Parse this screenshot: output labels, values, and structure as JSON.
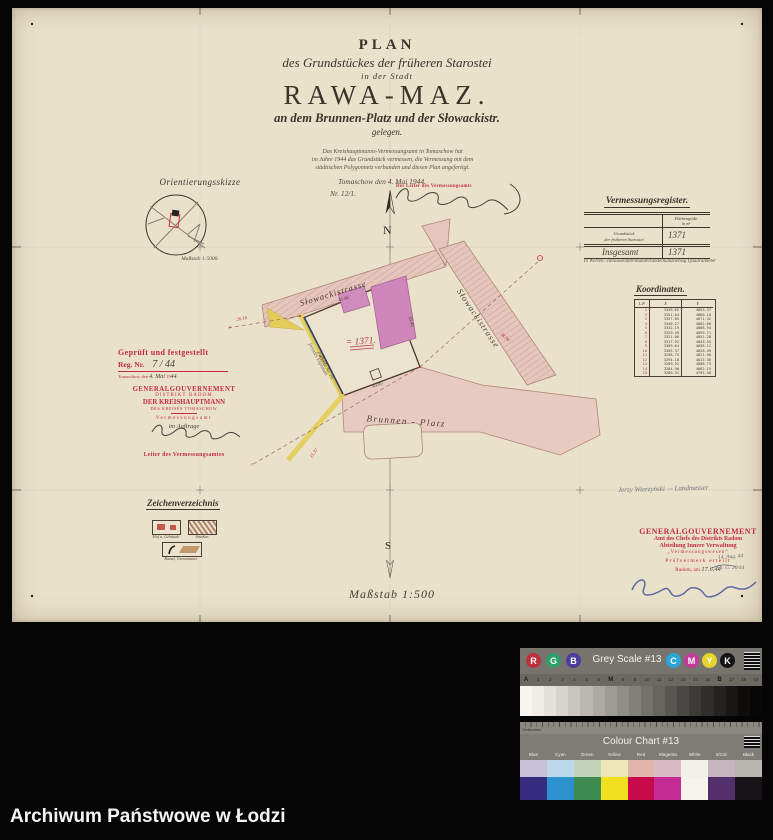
{
  "archive_bar": {
    "label": "Archiwum Państwowe w Łodzi"
  },
  "title_block": {
    "line1": "PLAN",
    "line2": "des Grundstückes der früheren Starostei",
    "line3": "in der Stadt",
    "line4": "RAWA-MAZ.",
    "line5": "an dem Brunnen-Platz und der Słowackistr.",
    "line6": "gelegen."
  },
  "certification": {
    "line1": "Das Kreishauptmanns-Vermessungsamt in Tomaschow hat",
    "line2": "im Jahre 1944 das Grundstück vermessen, die Vermessung mit dem",
    "line3": "städtischen Polygonnetz verbunden und diesen Plan angefertigt.",
    "place_date": "Tomaschow den 4. Mai 1944.",
    "number": "Nr. 12/1.",
    "stamp_label": "Der Leiter des Vermessungsamts"
  },
  "orientation": {
    "title": "Orientierungsskizze",
    "scale": "Maßstab 1:5000."
  },
  "register": {
    "title": "Vermessungsregister.",
    "col_header_1": "Flächengröße",
    "col_header_2": "in m²",
    "row1_label_1": "Grundstück",
    "row1_label_2": "der früheren Starostei",
    "row1_value": "1371",
    "row2_label": "Insgesamt",
    "row2_value": "1371",
    "in_words": "In Worten: eintausenddreihundertundeinundsiebzig Quadratmeter"
  },
  "koordinaten": {
    "title": "Koordinaten.",
    "headers": {
      "lp": "L.P.",
      "x": "X",
      "y": "Y"
    },
    "rows": [
      [
        "1",
        "3349.62",
        "4853.37"
      ],
      [
        "2",
        "3351.04",
        "4860.18"
      ],
      [
        "3",
        "3357.85",
        "4871.42"
      ],
      [
        "4",
        "3340.27",
        "4882.66"
      ],
      [
        "5",
        "3332.19",
        "4868.94"
      ],
      [
        "6",
        "3329.45",
        "4859.71"
      ],
      [
        "7",
        "3321.06",
        "4851.28"
      ],
      [
        "8",
        "3317.92",
        "4843.55"
      ],
      [
        "9",
        "3309.64",
        "4836.12"
      ],
      [
        "10",
        "3305.37",
        "4828.49"
      ],
      [
        "11",
        "3298.75",
        "4821.90"
      ],
      [
        "12",
        "3294.18",
        "4815.36"
      ],
      [
        "13",
        "3289.52",
        "4808.73"
      ],
      [
        "14",
        "3284.90",
        "4802.15"
      ],
      [
        "15",
        "3280.31",
        "4795.58"
      ]
    ]
  },
  "stamp_left": {
    "line1": "Geprüft und festgestellt",
    "reg_label": "Reg. Nr.",
    "reg_value": "7 / 44",
    "date_label": "Tomaschow, den",
    "date_value": "4. Mai",
    "year_prefix": "19",
    "year_value": "44",
    "org1": "GENERALGOUVERNEMENT",
    "org2": "DISTRIKT RADOM",
    "org3": "DER KREISHAUPTMANN",
    "org4": "DES KREISES TOMASCHOW",
    "office": "Vermessungsamt",
    "by_order": "im Auftrage",
    "signer": "Leiter des Vermessungsamtes"
  },
  "pencil_note": {
    "text": "Jerzy Wierzyński — Landmesser"
  },
  "stamp_right": {
    "line1": "GENERALGOUVERNEMENT",
    "line2": "Amt des Chefs des Distrikts Radom",
    "line3": "Abteilung Innere Verwaltung",
    "line4": "„Vermessungswesen“",
    "line5": "Prüfvermerk erteilt",
    "line6": "Radom, am",
    "line6_value": "17.6.44",
    "note1": "14. Aug. 44",
    "note2": "Nb. G. 20/44"
  },
  "plan": {
    "north": "N",
    "south": "S",
    "street_top": "Słowackistrasse",
    "street_right": "Słowackistrasse",
    "square": "Brunnen - Platz",
    "area_label": "= 1371.",
    "left_note1": "fremdes Eigentum",
    "left_note2": "Parzelle Nr. 19",
    "scale": "Maßstab 1:500",
    "measurements": [
      {
        "t": "26.10",
        "x": 230,
        "y": 312,
        "r": -9,
        "c": "red"
      },
      {
        "t": "15.37",
        "x": 303,
        "y": 446,
        "r": -55,
        "c": "red"
      },
      {
        "t": "38.94",
        "x": 492,
        "y": 330,
        "r": 42,
        "c": "red"
      },
      {
        "t": "41.66",
        "x": 332,
        "y": 292,
        "r": -17,
        "c": "ink"
      },
      {
        "t": "35.40",
        "x": 398,
        "y": 314,
        "r": 72,
        "c": "ink"
      },
      {
        "t": "43.85",
        "x": 366,
        "y": 378,
        "r": -20,
        "c": "ink"
      },
      {
        "t": "29.12",
        "x": 310,
        "y": 352,
        "r": 62,
        "c": "ink"
      },
      {
        "t": "×",
        "x": 218,
        "y": 321,
        "r": 0,
        "c": "red"
      },
      {
        "t": "×",
        "x": 240,
        "y": 458,
        "r": 0,
        "c": "red"
      }
    ]
  },
  "legend": {
    "title": "Zeichenverzeichnis",
    "items": [
      {
        "label": "Hof u. Gebäude"
      },
      {
        "label": "Straßen"
      },
      {
        "label": "Kanal, Grenzmauer"
      }
    ]
  },
  "grey_scale": {
    "title": "Grey Scale #13",
    "circles": [
      {
        "letter": "R",
        "color": "#bf2f3c",
        "x": 6
      },
      {
        "letter": "G",
        "color": "#2f9e68",
        "x": 26
      },
      {
        "letter": "B",
        "color": "#4a3e9d",
        "x": 46
      },
      {
        "letter": "C",
        "color": "#2aa6d9",
        "x": 146
      },
      {
        "letter": "M",
        "color": "#c43a9b",
        "x": 164
      },
      {
        "letter": "Y",
        "color": "#e6d32b",
        "x": 182
      },
      {
        "letter": "K",
        "color": "#151515",
        "x": 200
      }
    ],
    "ticks": [
      "A",
      "1",
      "2",
      "3",
      "4",
      "5",
      "6",
      "M",
      "8",
      "9",
      "10",
      "11",
      "12",
      "13",
      "14",
      "15",
      "B",
      "17",
      "18",
      "19"
    ],
    "steps": [
      "#f7f5ee",
      "#efede6",
      "#e3e1da",
      "#d6d4cd",
      "#c8c6bf",
      "#bab8b1",
      "#acaaa3",
      "#9e9c95",
      "#908e88",
      "#82807a",
      "#74726c",
      "#66645f",
      "#585651",
      "#4a4844",
      "#3d3b37",
      "#302e2b",
      "#242220",
      "#181715",
      "#0e0d0c",
      "#070706"
    ]
  },
  "colour_chart": {
    "title": "Colour Chart #13",
    "ruler_label": "Centimetres",
    "columns": [
      {
        "label": "Blue",
        "light": "#c7c1da",
        "full": "#362c80"
      },
      {
        "label": "Cyan",
        "light": "#bdd8e9",
        "full": "#2b92cf"
      },
      {
        "label": "Green",
        "light": "#c4d4ba",
        "full": "#3d8b52"
      },
      {
        "label": "Yellow",
        "light": "#ede7b5",
        "full": "#f1e01f"
      },
      {
        "label": "Red",
        "light": "#e3b4ac",
        "full": "#c60a4a"
      },
      {
        "label": "Magenta",
        "light": "#dabbc5",
        "full": "#c52b95"
      },
      {
        "label": "White",
        "light": "#f2efe6",
        "full": "#f6f3ea"
      },
      {
        "label": "3/Col.",
        "light": "#c6b4be",
        "full": "#53306b"
      },
      {
        "label": "Black",
        "light": "#b9b6b2",
        "full": "#161418"
      }
    ]
  },
  "colors": {
    "stamp_red": "#c22c3e",
    "area_red": "#b5333e",
    "street_pink": "#e5c6bc",
    "building_magenta": "#cf86ba",
    "strip_yellow": "#e3cd58",
    "paper": "#eae1cb"
  }
}
